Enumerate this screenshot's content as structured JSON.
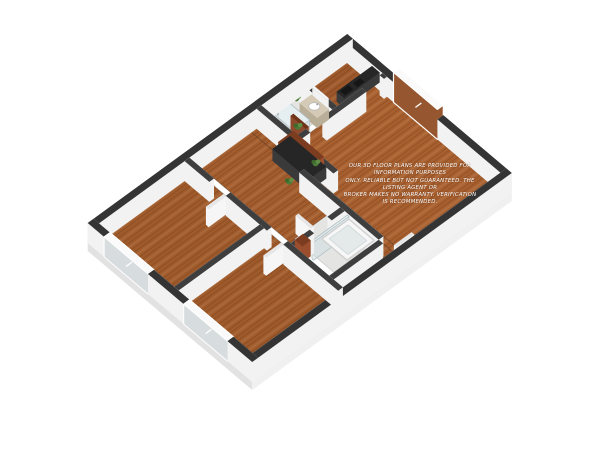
{
  "scene": {
    "type": "3d-floorplan-dollhouse-render",
    "background": "#ffffff"
  },
  "disclaimer": {
    "line1": "OUR 3D FLOOR PLANS ARE PROVIDED FOR INFORMATION PURPOSES",
    "line2": "ONLY. RELIABLE BUT NOT GUARANTEED. THE LISTING AGENT OR",
    "line3": "BROKER MAKES NO WARRANTY. VERIFICATION IS RECOMMENDED.",
    "color": "#ffffff"
  },
  "palette": {
    "background": "#ffffff",
    "wall_cap_exterior": "#343434",
    "wall_cap_interior": "#3e3e3e",
    "wall_face": "#f2f2f2",
    "plinth_left": "#e2e2e2",
    "plinth_right": "#f0f0f0",
    "wood_living": "#a75f2f",
    "wood_bedroom": "#9f5a2b",
    "wood_hall": "#a25c2d",
    "wood_kitchen": "#9c572a",
    "wood_grain_dark": "rgba(80,40,12,0.28)",
    "wood_grain_light": "rgba(255,225,190,0.10)",
    "bath_floor": "#e4e4e2",
    "cabinet_face": "#9a4e2e",
    "cabinet_top": "#7c3c20",
    "counter_dark_top": "#262626",
    "counter_dark_face": "#3a3a3a",
    "cooktop_black": "#161616",
    "glass_face": "rgba(206,221,226,0.5)",
    "glass_top": "rgba(235,243,245,0.65)",
    "glass_edge": "#aebcc1",
    "window_pane": "#d7dcde",
    "window_frame": "#fafafa",
    "window_view_wood": "#96562f",
    "door_white_face": "#f6f6f6",
    "door_white_top": "#e6e6e6",
    "door_brown_face": "#8d4a2c",
    "door_brown_top": "#6f3519",
    "vanity_face": "#b9ae98",
    "vanity_top": "#d4cab6",
    "tub_white": "#f7f7f7",
    "tub_inner": "#e4e9ea",
    "plant_green": "#4c7a37",
    "plant_green_light": "#5f8f44",
    "flower_purple": "#a468c8",
    "chrome": "#9aa0a3"
  }
}
